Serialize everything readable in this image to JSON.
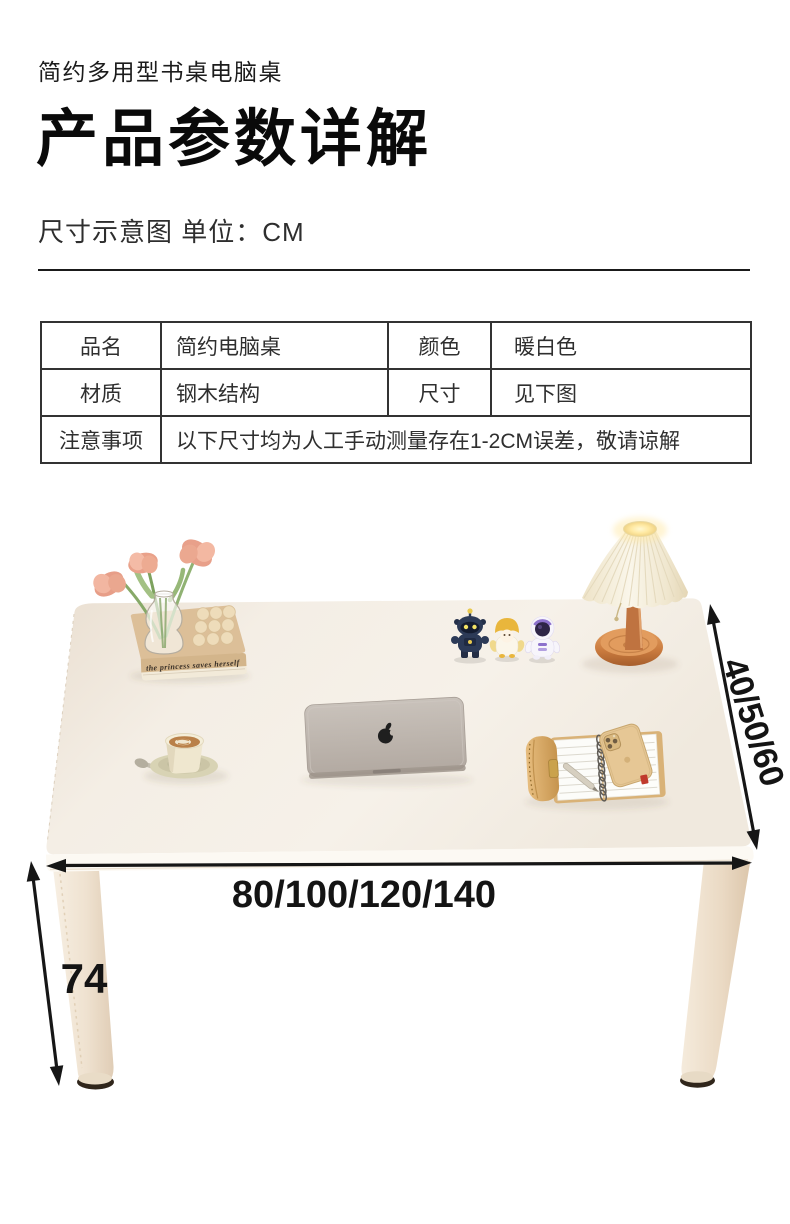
{
  "header": {
    "product_line": "简约多用型书桌电脑桌",
    "title": "产品参数详解",
    "subtitle": "尺寸示意图 单位：CM"
  },
  "spec_table": {
    "rows": [
      {
        "c0": "品名",
        "c1": "简约电脑桌",
        "c2": "颜色",
        "c3": "暖白色"
      },
      {
        "c0": "材质",
        "c1": "钢木结构",
        "c2": "尺寸",
        "c3": "见下图"
      },
      {
        "c0": "注意事项",
        "c1": "以下尺寸均为人工手动测量存在1-2CM误差，敬请谅解"
      }
    ]
  },
  "diagram": {
    "width_label": "80/100/120/140",
    "depth_label": "40/50/60",
    "height_label": "74",
    "book_title": "the princess saves herself",
    "colors": {
      "desk_top": "#f3ece2",
      "desk_edge": "#fbf8f2",
      "leg": "#efe3d2",
      "arrow": "#161616",
      "lamp_base": "#cd7f45",
      "lamp_shade": "#f6efdd"
    }
  }
}
